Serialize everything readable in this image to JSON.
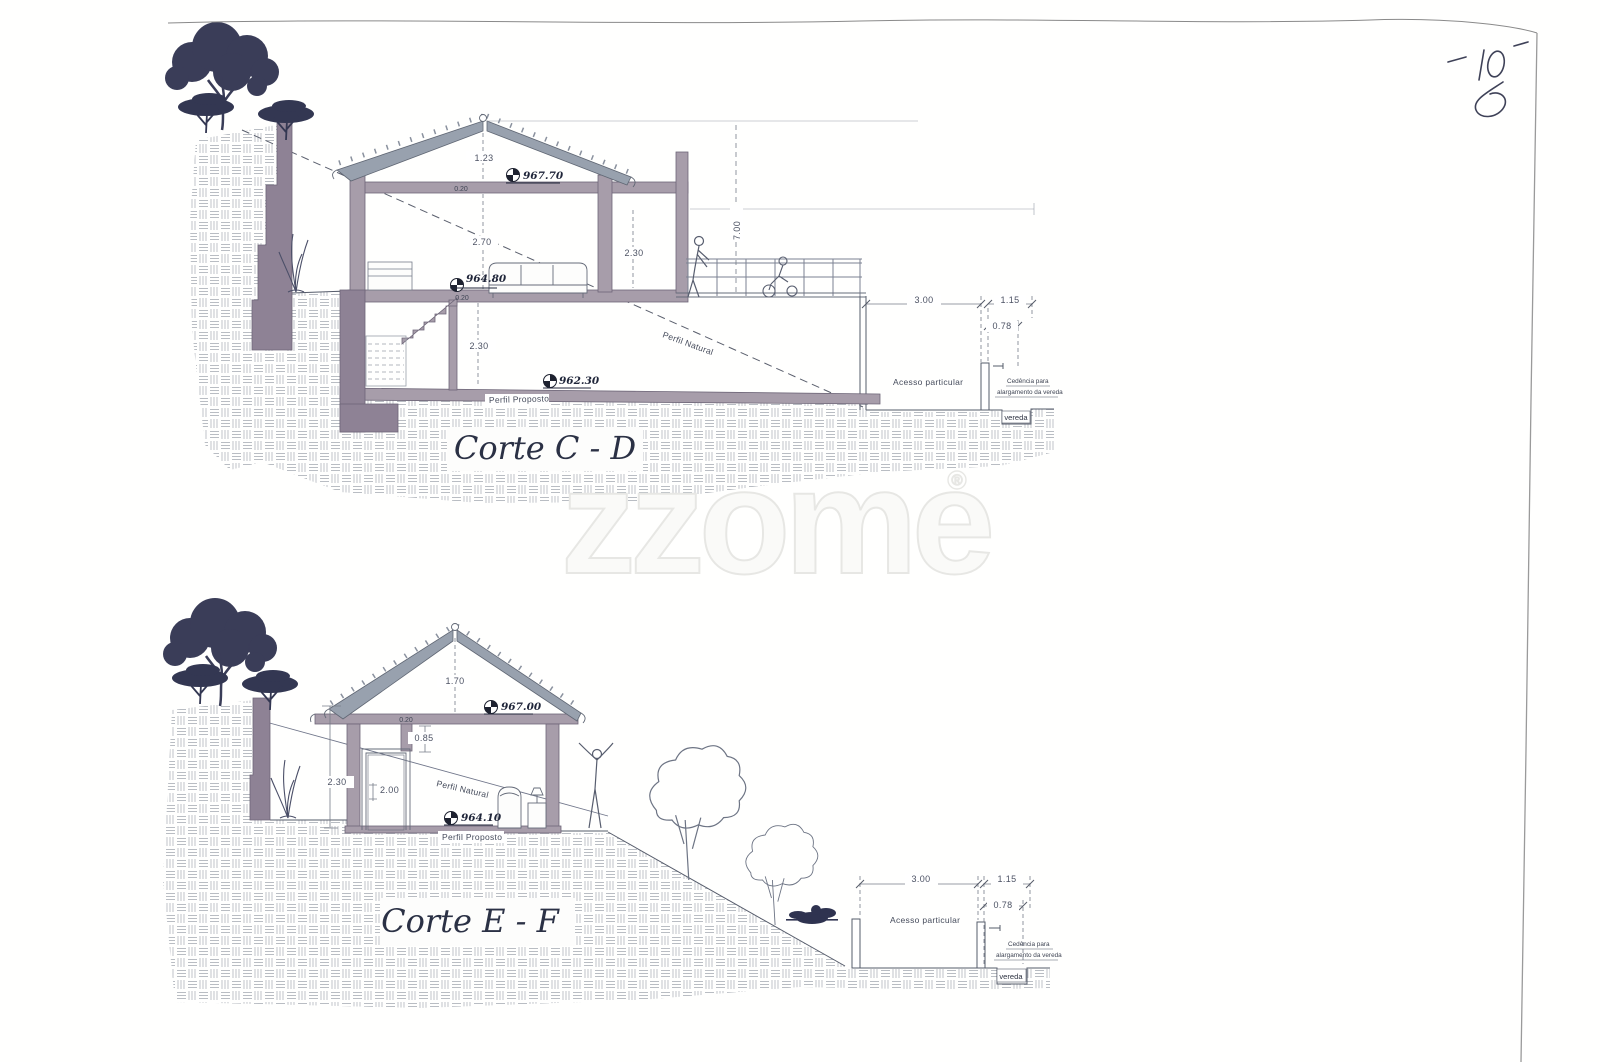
{
  "page": {
    "number": "10",
    "watermark": "zzome",
    "watermark_mark": "®"
  },
  "corte_cd": {
    "title": "Corte C - D",
    "levels": {
      "ridge": "967.70",
      "floor": "964.80",
      "lower_floor": "962.30"
    },
    "dims": {
      "roof_height": "1.23",
      "slab_top": "0.20",
      "room_height": "2.70",
      "annex_height": "2.30",
      "slab_mid": "0.20",
      "lower_height": "2.30",
      "total_height": "7.00",
      "access_width": "3.00",
      "strip_width": "1.15",
      "offset_width": "0.78"
    },
    "labels": {
      "natural": "Perfil Natural",
      "proposed": "Perfil Proposto",
      "access": "Acesso particular",
      "cedencia_1": "Cedência para",
      "cedencia_2": "alargamento da vereda",
      "path": "vereda"
    }
  },
  "corte_ef": {
    "title": "Corte E - F",
    "levels": {
      "ridge": "967.00",
      "floor": "964.10"
    },
    "dims": {
      "roof_height": "1.70",
      "slab_top": "0.20",
      "beam_drop": "0.85",
      "wall_height": "2.30",
      "door_height": "2.00",
      "access_width": "3.00",
      "strip_width": "1.15",
      "offset_width": "0.78"
    },
    "labels": {
      "natural": "Perfil Natural",
      "proposed": "Perfil Proposto",
      "access": "Acesso particular",
      "cedencia_1": "Cedência para",
      "cedencia_2": "alargamento da vereda",
      "path": "vereda"
    }
  }
}
